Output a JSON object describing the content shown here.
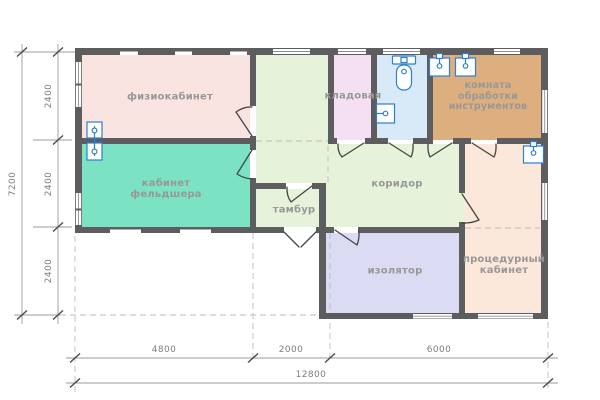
{
  "type": "architectural-floor-plan",
  "rooms": [
    {
      "id": "physio",
      "label": "физиокабинет",
      "color": "#f9e4e2"
    },
    {
      "id": "feldsher",
      "label": "кабинет фельдшера",
      "color": "#7be2c3"
    },
    {
      "id": "kladovaya",
      "label": "кладовая",
      "color": "#f4e0f2"
    },
    {
      "id": "bathroom",
      "label": "",
      "color": "#d8e9f8"
    },
    {
      "id": "instruments",
      "label": "комната обработки инструментов",
      "color": "#ddae7e"
    },
    {
      "id": "tambur",
      "label": "тамбур",
      "color": "#e7f2da"
    },
    {
      "id": "corridor",
      "label": "коридор",
      "color": "#e7f2da"
    },
    {
      "id": "isolator",
      "label": "изолятор",
      "color": "#dbdcf3"
    },
    {
      "id": "procedure",
      "label": "процедурный кабинет",
      "color": "#fbe8da"
    }
  ],
  "dimensions": {
    "left_total": "7200",
    "left_segments": [
      "2400",
      "2400",
      "2400"
    ],
    "bottom_segments": [
      "4800",
      "2000",
      "6000"
    ],
    "bottom_total": "12800"
  },
  "fixtures": [
    "toilet",
    "sink-bathroom",
    "sink-instruments-1",
    "sink-instruments-2",
    "sink-procedure",
    "twin-sink-wall"
  ],
  "colors": {
    "background": "#ffffff",
    "wall": "#5d5c5e",
    "label": "#989898",
    "dimtext": "#7d7d7d",
    "dimline": "#9b9b9b",
    "dimtick": "#4f4f4f",
    "grid": "#bdbdbd",
    "door": "#454545",
    "fixture": "#2b7fd4",
    "window_line": "#8f8f8f"
  }
}
